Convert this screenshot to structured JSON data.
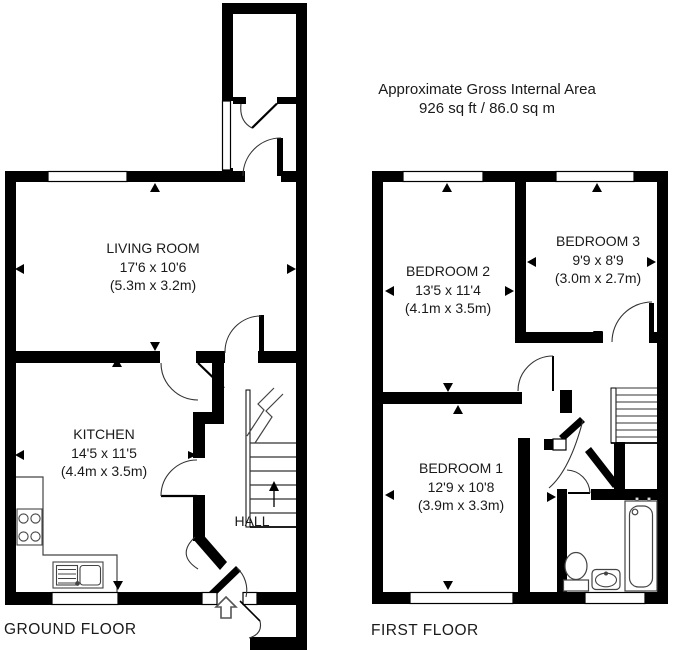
{
  "title": {
    "line1": "Approximate Gross Internal Area",
    "line2": "926 sq ft / 86.0 sq m"
  },
  "ground_floor": {
    "label": "GROUND FLOOR",
    "rooms": {
      "living_room": {
        "name": "LIVING ROOM",
        "dims_imperial": "17'6 x 10'6",
        "dims_metric": "(5.3m x 3.2m)"
      },
      "kitchen": {
        "name": "KITCHEN",
        "dims_imperial": "14'5 x 11'5",
        "dims_metric": "(4.4m x 3.5m)"
      },
      "hall": {
        "name": "HALL"
      }
    }
  },
  "first_floor": {
    "label": "FIRST FLOOR",
    "rooms": {
      "bedroom_1": {
        "name": "BEDROOM 1",
        "dims_imperial": "12'9 x 10'8",
        "dims_metric": "(3.9m x 3.3m)"
      },
      "bedroom_2": {
        "name": "BEDROOM 2",
        "dims_imperial": "13'5 x 11'4",
        "dims_metric": "(4.1m x 3.5m)"
      },
      "bedroom_3": {
        "name": "BEDROOM 3",
        "dims_imperial": "9'9 x 8'9",
        "dims_metric": "(3.0m x 2.7m)"
      }
    }
  },
  "colors": {
    "wall": "#000000",
    "background": "#ffffff",
    "text": "#1a1a1a"
  }
}
